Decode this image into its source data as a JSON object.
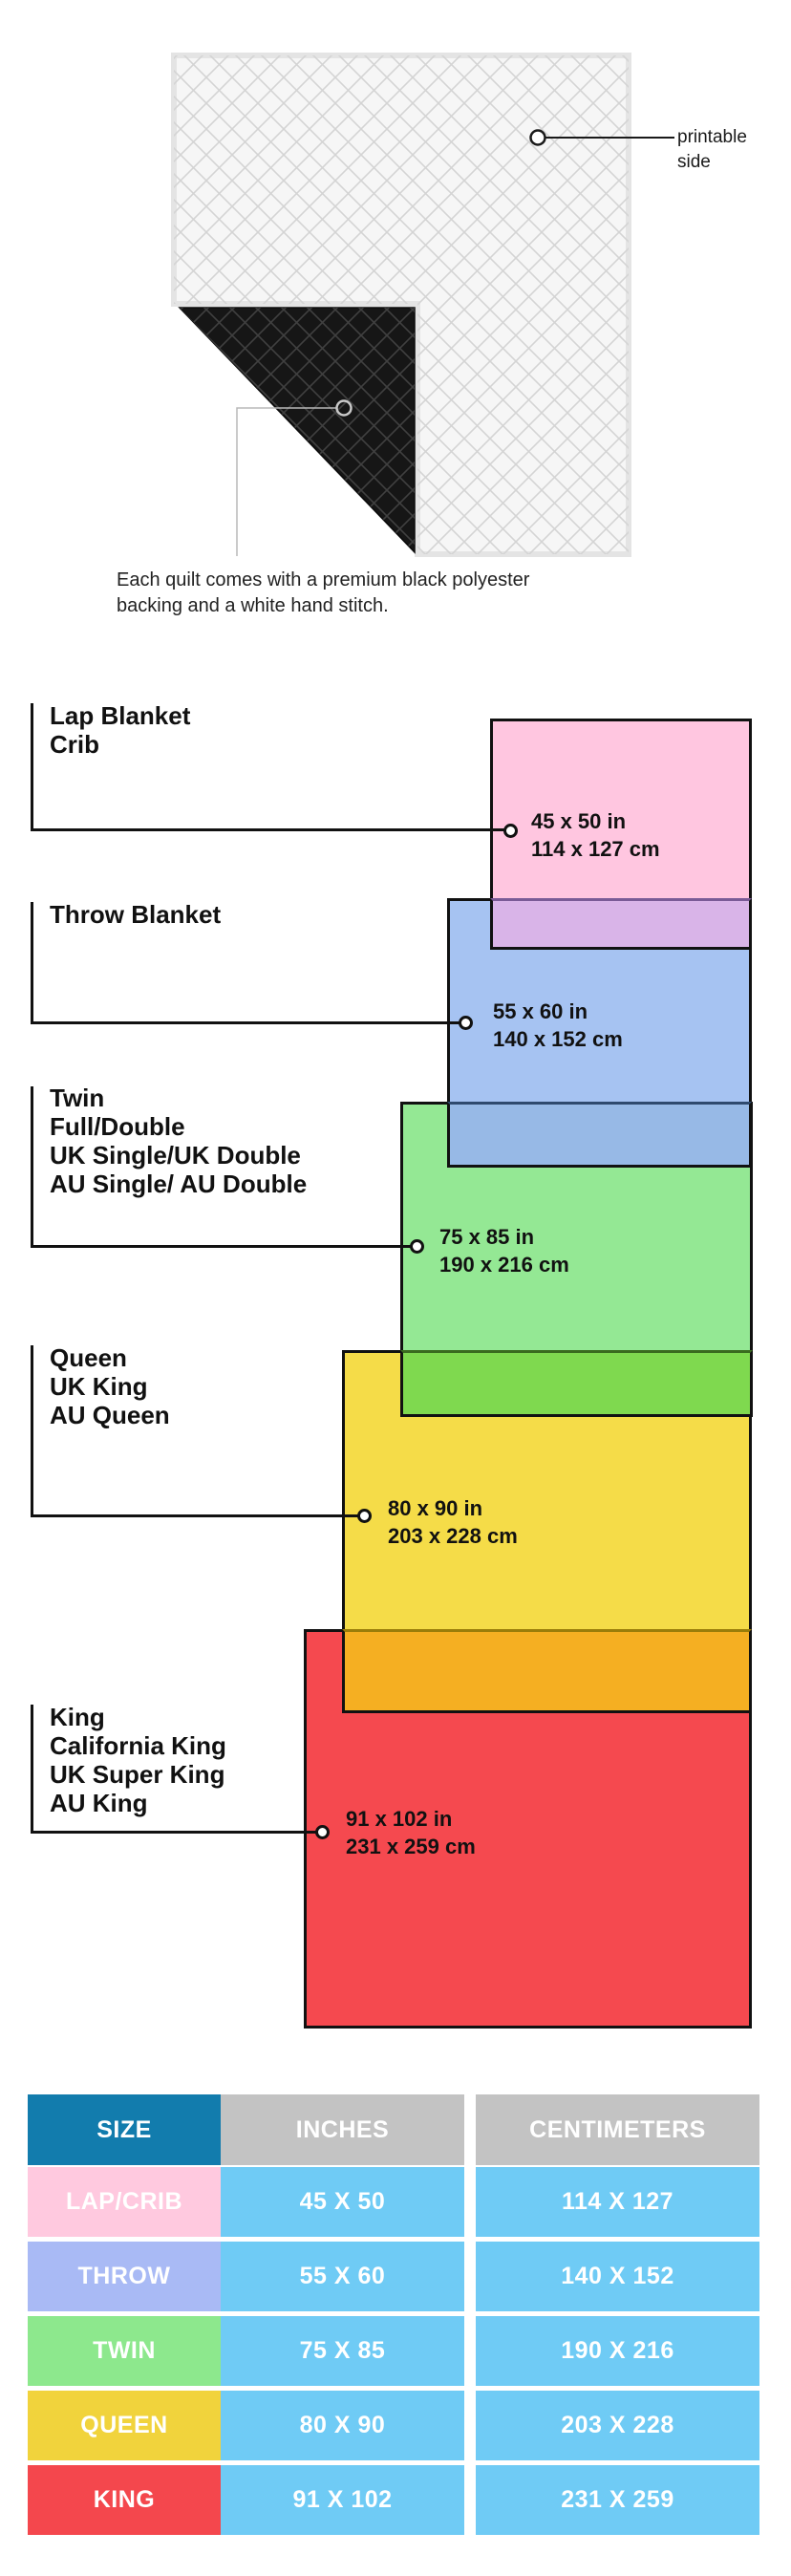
{
  "illustration": {
    "printable_callout": {
      "line1": "printable",
      "line2": "side"
    },
    "caption": {
      "line1": "Each quilt comes with a premium black polyester",
      "line2": "backing and a white hand stitch."
    },
    "colors": {
      "quilt_front": "#f6f6f6",
      "quilt_back": "#161616",
      "binding": "#e4e4e4",
      "callout_gray": "#b8b8b8"
    }
  },
  "diagram": {
    "border_color": "#111111",
    "sizes": [
      {
        "name": "lap-crib",
        "label_lines": [
          "Lap Blanket",
          "Crib",
          "",
          ""
        ],
        "inches": "45 x 50 in",
        "centimeters": "114 x 127 cm",
        "fill": "#FFC6E0",
        "overlap_fill": "#D9B4E8",
        "overlap_border": "#7A5A96"
      },
      {
        "name": "throw",
        "label_lines": [
          "Throw Blanket",
          "",
          "",
          ""
        ],
        "inches": "55 x 60 in",
        "centimeters": "140 x 152 cm",
        "fill": "#A6C3F2",
        "overlap_fill": "#97B9E6",
        "overlap_border": "#2F4A6E"
      },
      {
        "name": "twin",
        "label_lines": [
          "Twin",
          "Full/Double",
          "UK Single/UK Double",
          "AU Single/ AU Double"
        ],
        "inches": "75 x 85 in",
        "centimeters": "190 x 216 cm",
        "fill": "#94E894",
        "overlap_fill": "#7FD94F",
        "overlap_border": "#3A6B1F"
      },
      {
        "name": "queen",
        "label_lines": [
          "Queen",
          "UK King",
          "AU Queen",
          ""
        ],
        "inches": "80 x 90 in",
        "centimeters": "203 x 228 cm",
        "fill": "#F5DC48",
        "overlap_fill": "#F5AF22",
        "overlap_border": "#9A7D0A"
      },
      {
        "name": "king",
        "label_lines": [
          "King",
          "California King",
          "UK Super King",
          "AU King"
        ],
        "inches": "91 x 102 in",
        "centimeters": "231 x 259 cm",
        "fill": "#F5494F"
      }
    ]
  },
  "table": {
    "headers": {
      "size": "SIZE",
      "inches": "INCHES",
      "centimeters": "CENTIMETERS"
    },
    "header_size_bg": "#127CAD",
    "header_other_bg": "#C3C3C3",
    "value_bg": "#6FCBF5",
    "text_color": "#FFFFFF",
    "rows": [
      {
        "size": "LAP/CRIB",
        "inches": "45 X 50",
        "centimeters": "114 X 127",
        "bg": "#FFC9DF"
      },
      {
        "size": "THROW",
        "inches": "55 X 60",
        "centimeters": "140 X 152",
        "bg": "#A9BAF5"
      },
      {
        "size": "TWIN",
        "inches": "75 X 85",
        "centimeters": "190 X 216",
        "bg": "#8DE88D"
      },
      {
        "size": "QUEEN",
        "inches": "80 X 90",
        "centimeters": "203 X 228",
        "bg": "#F1D33C"
      },
      {
        "size": "KING",
        "inches": "91 X 102",
        "centimeters": "231 X 259",
        "bg": "#F4474D"
      }
    ]
  }
}
